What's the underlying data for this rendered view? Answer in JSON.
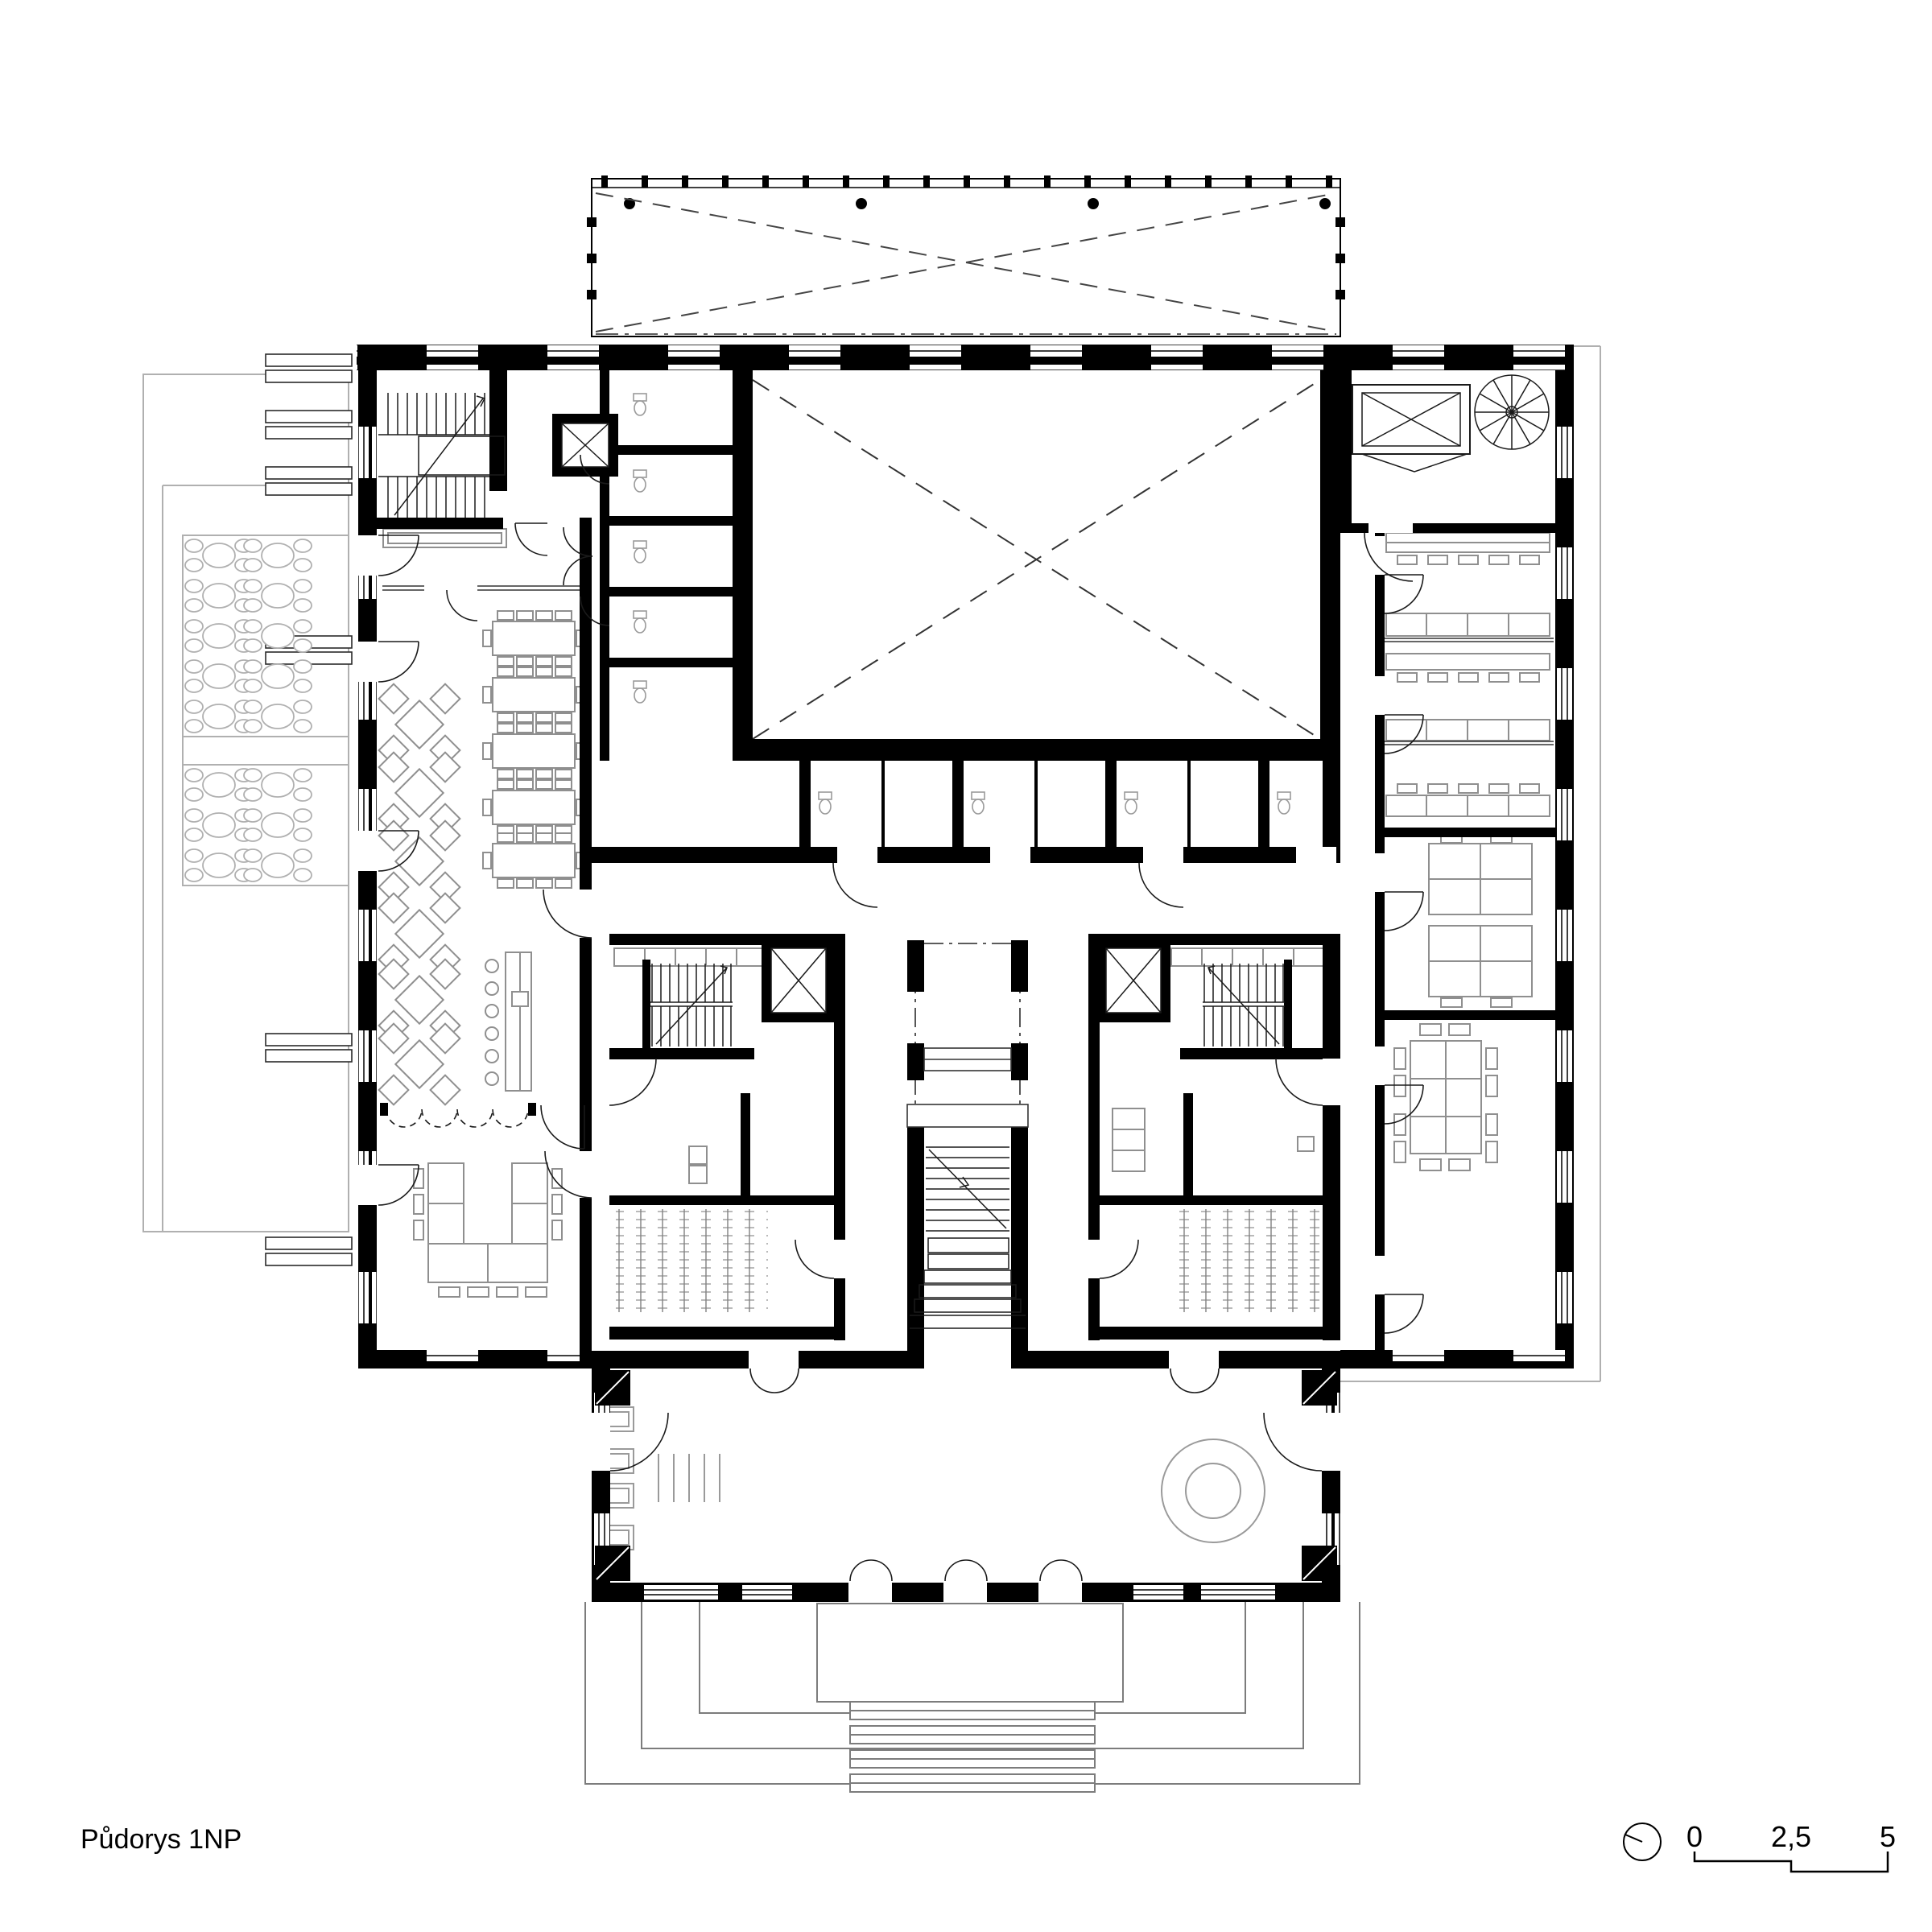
{
  "title": {
    "label": "Půdorys 1NP"
  },
  "scale_bar": {
    "start": "0",
    "middle": "2,5",
    "end": "5"
  },
  "icons": {
    "north_indicator": "north-indicator-icon",
    "elevator": "elevator-icon",
    "spiral_stair": "spiral-stair-icon",
    "skylight": "skylight-icon"
  },
  "colors": {
    "wall": "#000000",
    "paper": "#ffffff",
    "furniture_line": "#8f8f8f",
    "site_line": "#b0b0b0",
    "thin_line": "#1a1a1a"
  }
}
